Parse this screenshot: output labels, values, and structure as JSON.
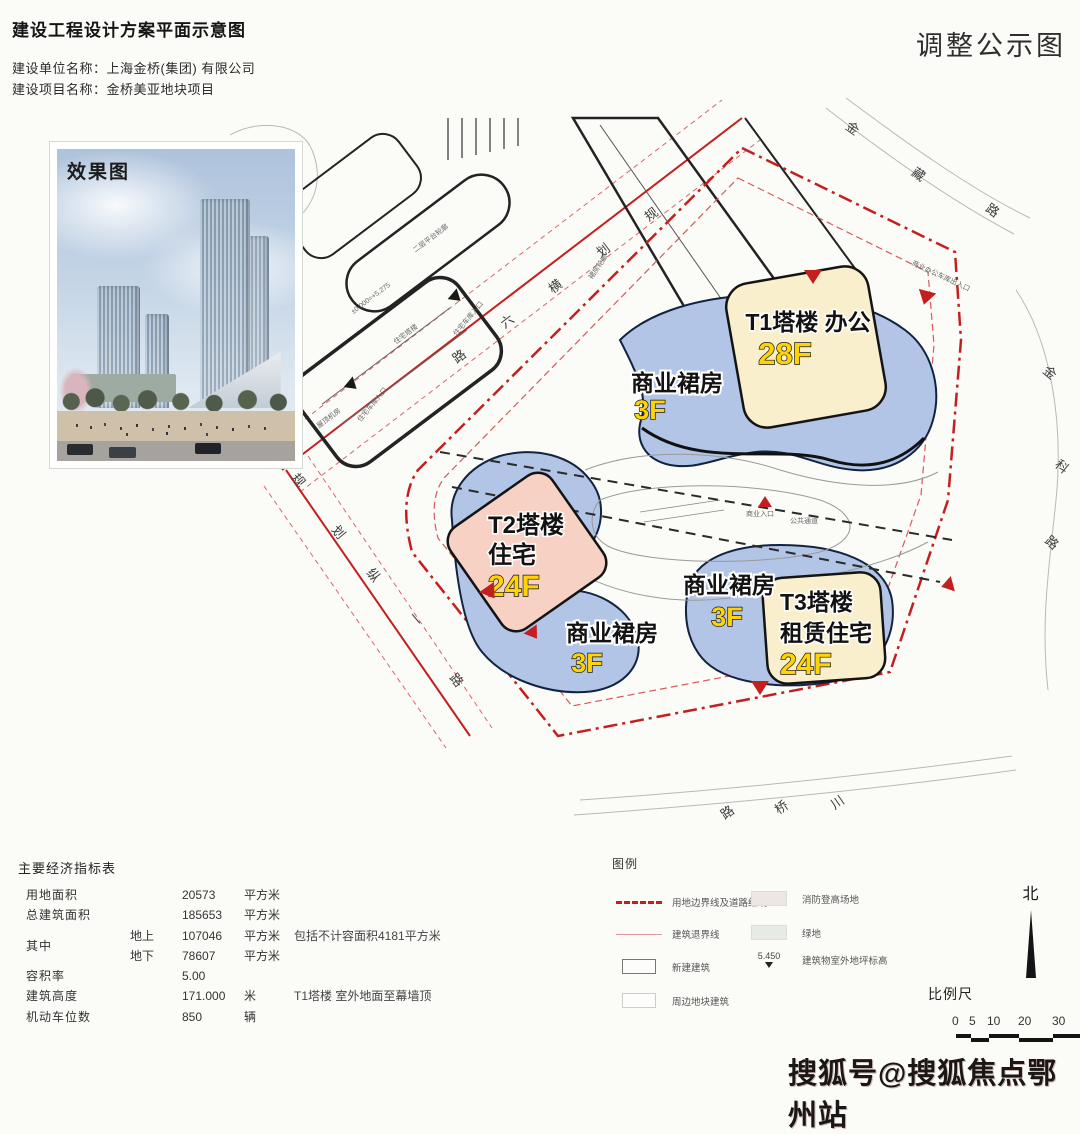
{
  "header": {
    "title": "建设工程设计方案平面示意图",
    "corner_title": "调整公示图",
    "builder_line": "建设单位名称：上海金桥(集团) 有限公司",
    "project_line": "建设项目名称：金桥美亚地块项目"
  },
  "inset": {
    "label": "效果图"
  },
  "plan": {
    "towers": {
      "t1": {
        "line1": "T1塔楼 办公",
        "floors": "28F"
      },
      "t2": {
        "line1": "T2塔楼",
        "line2": "住宅",
        "floors": "24F"
      },
      "t3": {
        "line1": "T3塔楼",
        "line2": "租赁住宅",
        "floors": "24F"
      }
    },
    "podiums": [
      {
        "label": "商业裙房",
        "floors": "3F"
      },
      {
        "label": "商业裙房",
        "floors": "3F"
      },
      {
        "label": "商业裙房",
        "floors": "3F"
      }
    ],
    "roads": [
      {
        "name": "规划横六路",
        "chars": [
          "规",
          "划",
          "横",
          "六",
          "路"
        ]
      },
      {
        "name": "规划纵一路",
        "chars": [
          "规",
          "划",
          "纵",
          "一",
          "路"
        ]
      },
      {
        "name": "金藏路",
        "chars": [
          "金",
          "藏",
          "路"
        ]
      },
      {
        "name": "金科路",
        "chars": [
          "金",
          "科",
          "路"
        ]
      },
      {
        "name": "川桥路",
        "chars": [
          "川",
          "桥",
          "路"
        ]
      }
    ],
    "annotations": [
      {
        "text": "二层平台轮廓"
      },
      {
        "text": "住宅塔楼"
      },
      {
        "text": "裙房轮廓"
      },
      {
        "text": "屋顶机房"
      },
      {
        "text": "±0.000=+5.275"
      },
      {
        "text": "住宅车库入口"
      },
      {
        "text": "住宅车库入口"
      },
      {
        "text": "商业办公车库出入口"
      },
      {
        "text": "商业入口"
      },
      {
        "text": "公共通道"
      }
    ]
  },
  "table": {
    "title": "主要经济指标表",
    "rows": [
      {
        "label": "用地面积",
        "sub": "",
        "value": "20573",
        "unit": "平方米",
        "note": ""
      },
      {
        "label": "总建筑面积",
        "sub": "",
        "value": "185653",
        "unit": "平方米",
        "note": ""
      },
      {
        "label": "其中",
        "sub": "地上",
        "value": "107046",
        "unit": "平方米",
        "note": "包括不计容面积4181平方米"
      },
      {
        "label": "",
        "sub": "地下",
        "value": "78607",
        "unit": "平方米",
        "note": ""
      },
      {
        "label": "容积率",
        "sub": "",
        "value": "5.00",
        "unit": "",
        "note": ""
      },
      {
        "label": "建筑高度",
        "sub": "",
        "value": "171.000",
        "unit": "米",
        "note": "T1塔楼  室外地面至幕墙顶"
      },
      {
        "label": "机动车位数",
        "sub": "",
        "value": "850",
        "unit": "辆",
        "note": ""
      }
    ]
  },
  "legend": {
    "title": "图例",
    "items_left": [
      {
        "label": "用地边界线及道路红线"
      },
      {
        "label": "建筑退界线"
      },
      {
        "label": "新建建筑"
      },
      {
        "label": "周边地块建筑"
      }
    ],
    "items_right": [
      {
        "label": "消防登高场地"
      },
      {
        "label": "绿地"
      },
      {
        "label": "建筑物室外地坪标高",
        "value": "5.450"
      }
    ]
  },
  "compass": {
    "label": "北"
  },
  "scalebar": {
    "label": "比例尺",
    "ticks": [
      "0",
      "5",
      "10",
      "20",
      "30"
    ]
  },
  "watermark": {
    "text": "搜狐号@搜狐焦点鄂州站"
  },
  "colors": {
    "boundary_red": "#c41f1f",
    "building_blue": "#b2c5e7",
    "tower_cream": "#f9efcc",
    "tower_pink": "#f7d2c4",
    "floor_yellow": "#ffd400"
  }
}
